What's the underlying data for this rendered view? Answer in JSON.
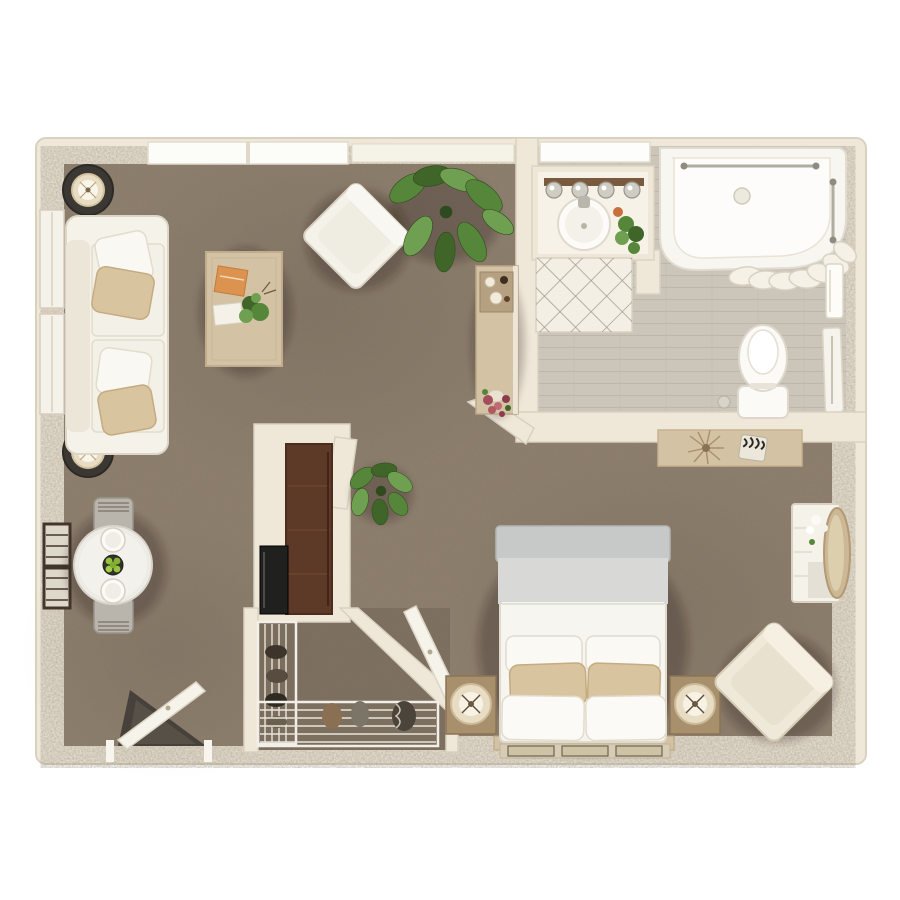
{
  "canvas": {
    "width": 900,
    "height": 900,
    "background": "#ffffff"
  },
  "colors": {
    "wall": "#efe8d9",
    "wall_edge": "#d9d1c0",
    "carpet": "#8a7a69",
    "carpet_shadow": "#32291f",
    "tile": "#cbc5ba",
    "tile_line": "#b7b1a5",
    "furniture_white": "#f5f2ea",
    "furniture_white_edge": "#ddd6c6",
    "wood_light": "#d4c2a4",
    "wood_mid": "#a8906c",
    "wood_dark": "#5d3a28",
    "appliance_black": "#20201e",
    "textile_beige": "#d9c4a0",
    "duvet_gray": "#c7c9c9",
    "rug_cream": "#f3efe4",
    "lamp_shade": "#e8dcc2",
    "charcoal_table": "#3b3833",
    "plant_dark": "#3f6628",
    "plant_mid": "#55863a",
    "plant_light": "#6f9f50",
    "flower_accent": "#a34e5c"
  },
  "floor_plan": {
    "type": "top-down 3D apartment render, studio / one-bedroom",
    "rooms": {
      "living_room": {
        "floor": "carpet",
        "furniture": [
          "sofa",
          "throw-pillows",
          "floor-lamp-top",
          "floor-lamp-bottom",
          "coffee-table",
          "books",
          "table-plant",
          "accent-armchair",
          "monstera-plant",
          "bar-console",
          "console-flowers"
        ]
      },
      "dining_area": {
        "floor": "carpet",
        "furniture": [
          "round-dining-table",
          "dining-chair-top",
          "dining-chair-bottom",
          "place-setting-top",
          "place-setting-bottom",
          "fruit-bowl"
        ]
      },
      "kitchenette": {
        "floor": "carpet",
        "furniture": [
          "tall-brown-cabinet",
          "black-appliance",
          "fiddle-leaf-plant"
        ]
      },
      "bathroom": {
        "floor": "tile",
        "furniture": [
          "vanity-counter",
          "round-sink",
          "vanity-light-bar",
          "vanity-plant",
          "bathtub",
          "towel-bar",
          "shower-curtain",
          "toilet",
          "lattice-rug",
          "wall-towel",
          "towel-rail",
          "bathroom-window"
        ]
      },
      "bedroom": {
        "floor": "carpet",
        "furniture": [
          "queen-bed",
          "gray-duvet",
          "bed-pillows",
          "headboard",
          "nightstand-left",
          "nightstand-right",
          "table-lamp-left",
          "table-lamp-right",
          "media-console",
          "dried-plant",
          "zebra-box",
          "dresser",
          "round-mirror",
          "dresser-flowers",
          "bedroom-armchair",
          "bed-runner"
        ]
      },
      "walk_in_closet": {
        "floor": "carpet",
        "furniture": [
          "wire-shelving-left",
          "wire-shelving-bottom",
          "hanging-clothes",
          "stored-items",
          "closet-door"
        ]
      },
      "entry": {
        "furniture": [
          "entry-door",
          "door-mat"
        ]
      }
    },
    "windows": [
      "top-wall-window-pair",
      "top-wall-window-right",
      "left-wall-window-upper",
      "left-wall-window-lower",
      "left-wall-dark-window-pair",
      "bathroom-window"
    ],
    "doors": [
      "entry-door",
      "closet-door",
      "bathroom-door-panel"
    ]
  }
}
